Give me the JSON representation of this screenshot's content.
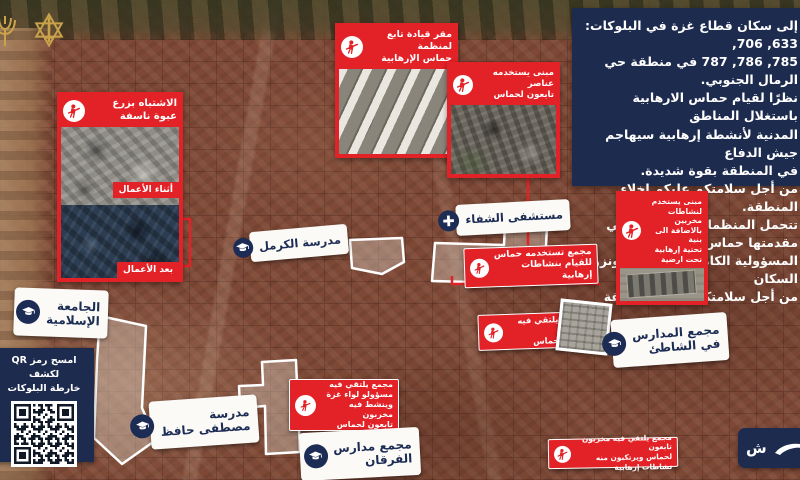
{
  "colors": {
    "red": "#e32227",
    "navy": "#1d2b4f",
    "label_text": "#1c2c55",
    "gold": "#c9a24a"
  },
  "warning_panel": {
    "lines": [
      "إلى سكان قطاع غزة في البلوكات: 633, 706,",
      "785, 786, 787 في منطقة حي الرمال الجنوبي.",
      "نظرًا لقيام حماس الارهابية باستغلال المناطق",
      "المدنية لأنشطة إرهابية سيهاجم جيش الدفاع",
      "في المنطقة بقوة شديدة.",
      "من أجل سلامتكم عليكم اخلاء المنطقة.",
      "تتحمل المنظمات الارهابية وفي مقدمتها حماس",
      "المسؤولية الكاملة عن معاناة ونزوح السكان",
      "من أجل سلامتكم اخلوا المنطقة"
    ]
  },
  "callouts": {
    "ied": {
      "lines": [
        "الاشتباه بزرع",
        "عبوة ناسفة"
      ],
      "tag_during": "أثناء الأعمال",
      "tag_after": "بعد الأعمال"
    },
    "hq": {
      "lines": [
        "مقر قيادة تابع لمنظمة",
        "حماس الإرهابية"
      ]
    },
    "building_operatives": {
      "lines": [
        "مبنى يستخدمه عناصر",
        "تابعون لحماس"
      ]
    },
    "underground": {
      "lines": [
        "مبنى يستخدم لنشاطات",
        "مخربين بالاضافة الى بنية",
        "تحتية إرهابية تحت ارضية"
      ]
    },
    "compound_hamas": {
      "lines": [
        "مجمع تستخدمه حماس",
        "للقيام بنشاطات إرهابية"
      ]
    },
    "leaders_meet": {
      "lines": [
        "مجمع يلتقي فيه قيادات",
        "تابعة لحماس"
      ]
    },
    "brigade_officials": {
      "lines": [
        "مجمع يلتقي فيه",
        "مسؤولو لواء غزة",
        "وينشط فيه مخربون",
        "تابعون لحماس"
      ]
    },
    "militants_meet": {
      "lines": [
        "مجمع يلتقي فيه مخربون تابعون",
        "لحماس ويرتكبون منه نشاطات إرهابية"
      ]
    }
  },
  "places": {
    "islamic_university": {
      "lines": [
        "الجامعة",
        "الإسلامية"
      ],
      "icon": "graduation-cap"
    },
    "karmel_school": {
      "lines": [
        "مدرسة الكرمل"
      ],
      "icon": "graduation-cap"
    },
    "shifa_hospital": {
      "lines": [
        "مستشفى الشفاء"
      ],
      "icon": "medical-cross"
    },
    "shati_schools": {
      "lines": [
        "مجمع المدارس",
        "في الشاطئ"
      ],
      "icon": "graduation-cap"
    },
    "mustafa_hafez_school": {
      "lines": [
        "مدرسة",
        "مصطفى حافظ"
      ],
      "icon": "graduation-cap"
    },
    "furqan_schools": {
      "lines": [
        "مجمع مدارس",
        "الفرقان"
      ],
      "icon": "graduation-cap"
    }
  },
  "qr_panel": {
    "lines": [
      "امسح رمز QR لكشف",
      "خارطة البلوكات"
    ]
  },
  "badge": {
    "visible_text": "ش"
  }
}
